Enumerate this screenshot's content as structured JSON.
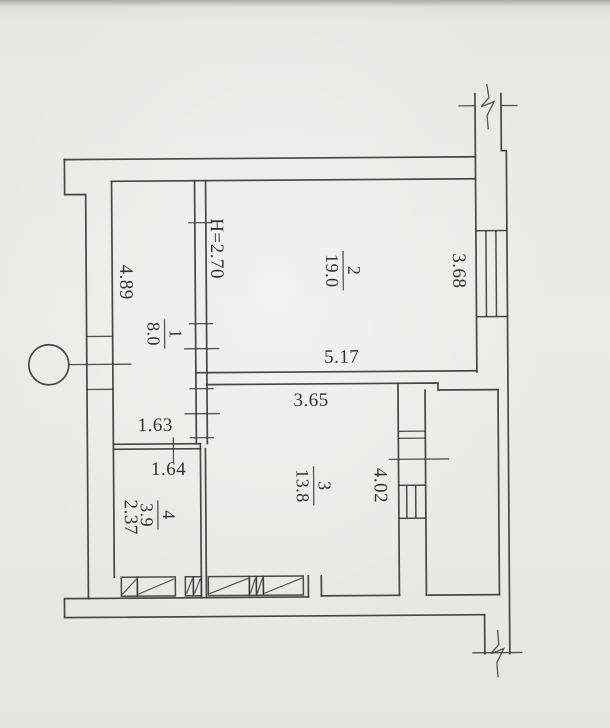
{
  "plan": {
    "ceiling_height_label": "H=2.70",
    "rooms": [
      {
        "number": "1",
        "area": "8.0"
      },
      {
        "number": "2",
        "area": "19.0"
      },
      {
        "number": "3",
        "area": "13.8"
      },
      {
        "number": "4",
        "area": "3.9"
      }
    ],
    "dimensions": {
      "corridor_length": "4.89",
      "room2_width": "5.17",
      "right_window": "3.68",
      "room3_width": "3.65",
      "loggia_depth": "4.02",
      "corridor_width": "1.63",
      "room4_width": "1.64",
      "room4_depth": "2.37"
    }
  },
  "colors": {
    "paper": "#e9e7e2",
    "ink": "#3c3a36"
  }
}
